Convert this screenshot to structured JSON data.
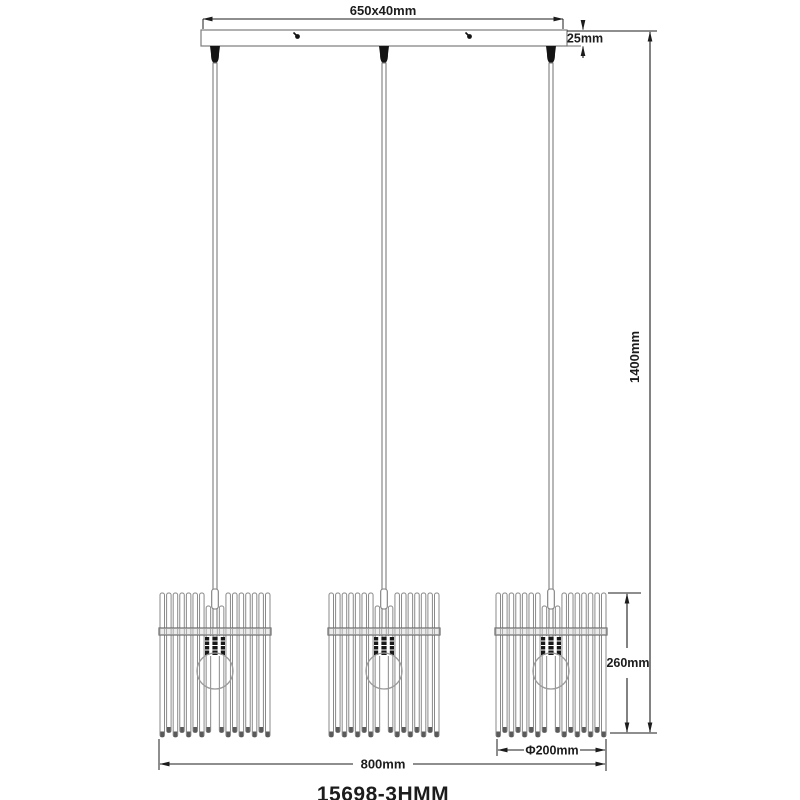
{
  "model_number": "15698-3HMM",
  "dimensions": {
    "canopy_size": "650x40mm",
    "canopy_height": "25mm",
    "overall_drop": "1400mm",
    "shade_height": "260mm",
    "shade_diameter": "Φ200mm",
    "overall_width": "800mm"
  },
  "drawing": {
    "type": "technical-dimension-diagram",
    "pendant_count": 3
  },
  "colors": {
    "background": "#ffffff",
    "fixture_line": "#8a8a8a",
    "dimension_line": "#1c1c1c",
    "connector_fill": "#141414"
  }
}
